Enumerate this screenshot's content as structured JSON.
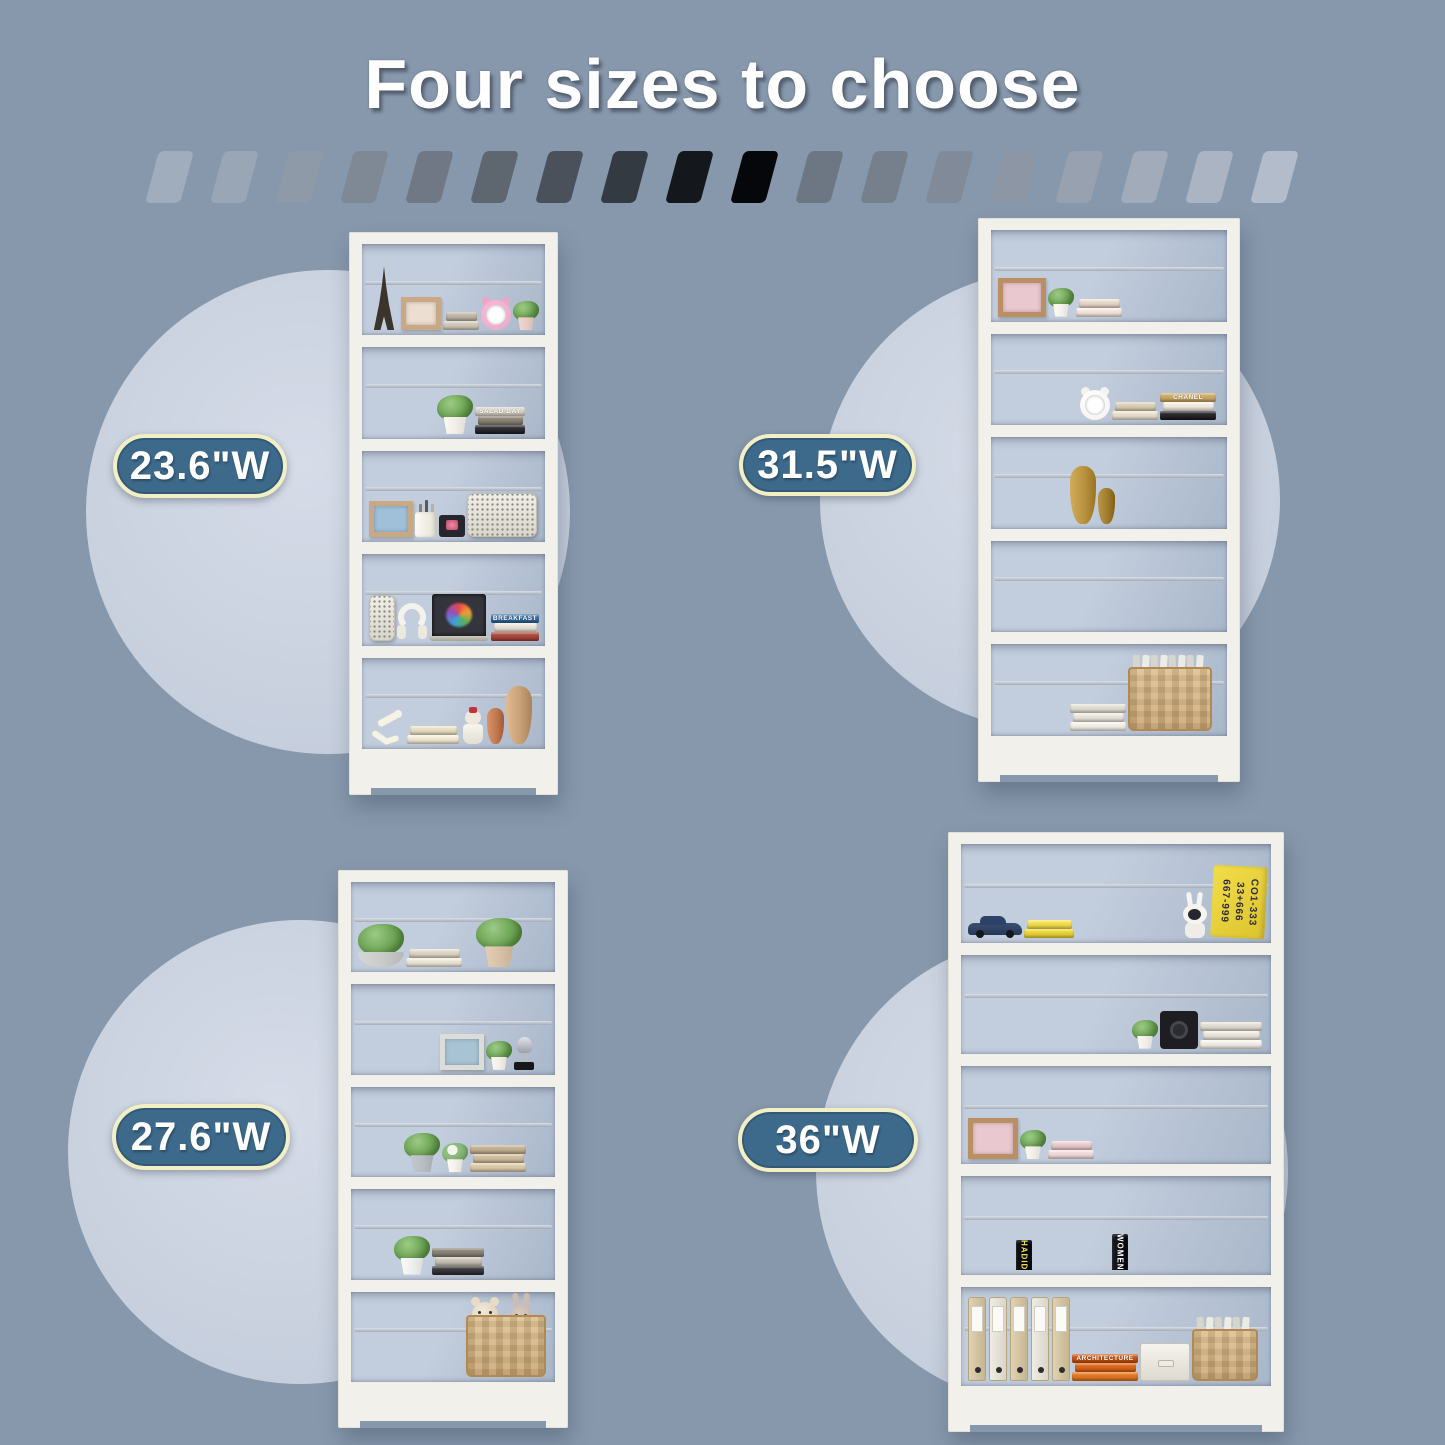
{
  "title": {
    "text": "Four sizes to choose"
  },
  "colors": {
    "background": "#8798ad",
    "circle_light": "#d6dce8",
    "circle_dark": "#c5cedc",
    "bookcase_frame": "#f2f0ea",
    "shelf_interior_light": "#c2cddd",
    "shelf_interior_dark": "#a9b7ca",
    "pill_fill": "#3d6a8b",
    "pill_border": "#f3efc5",
    "pill_text": "#ffffff",
    "title_text": "#ffffff"
  },
  "stripes": {
    "colors": [
      "#a0adbd",
      "#99a6b5",
      "#8f9aa9",
      "#7f8996",
      "#6f7884",
      "#5e666f",
      "#4a515a",
      "#343a42",
      "#14171c",
      "#06070a",
      "#6d7784",
      "#76808d",
      "#808a98",
      "#8c96a5",
      "#97a1b0",
      "#a1abba",
      "#aab4c3",
      "#b2bccb"
    ]
  },
  "sizes": [
    {
      "label": "23.6\"W",
      "position": "top-left"
    },
    {
      "label": "31.5\"W",
      "position": "top-right"
    },
    {
      "label": "27.6\"W",
      "position": "bottom-left"
    },
    {
      "label": "36\"W",
      "position": "bottom-right"
    }
  ],
  "bookcases": [
    {
      "size": "23.6\"W",
      "shelves": [
        [
          {
            "t": "tower"
          },
          {
            "t": "frame",
            "color": "#c9a985",
            "inner": "#ecdfd2",
            "size": 40
          },
          {
            "t": "stack",
            "colors": [
              "#cfc8ba",
              "#beb6a6"
            ],
            "w": 36
          },
          {
            "t": "clock",
            "color": "#e9a8c6"
          },
          {
            "t": "plant",
            "pot": "#e8cdc5",
            "size": "s"
          }
        ],
        [
          {
            "t": "books",
            "colors": [
              "#e6e1d7",
              "#3f3f45",
              "#23232a",
              "#b5a68c",
              "#6e6a60"
            ],
            "lean": [
              3
            ]
          },
          {
            "t": "plant",
            "pot": "#f2efe8",
            "size": "m"
          },
          {
            "t": "stack",
            "colors": [
              "#2e2e33",
              "#8c8375",
              "#d8d2c6"
            ],
            "w": 50,
            "label": "SALAD DAY"
          },
          {
            "t": "books",
            "colors": [
              "#efe9dd",
              "#3a3f52"
            ]
          }
        ],
        [
          {
            "t": "frame",
            "color": "#c9a985",
            "inner": "#9fc0d8",
            "size": 44
          },
          {
            "t": "cup"
          },
          {
            "t": "tv"
          },
          {
            "t": "speaker",
            "w": 70,
            "h": 44
          }
        ],
        [
          {
            "t": "speaker",
            "w": 26,
            "h": 46
          },
          {
            "t": "headphones"
          },
          {
            "t": "laptop",
            "w": 60
          },
          {
            "t": "stack",
            "colors": [
              "#a84a40",
              "#e8e2d6",
              "#3b6fa0"
            ],
            "w": 48,
            "label": "BREAKFAST"
          }
        ],
        [
          {
            "t": "figurine"
          },
          {
            "t": "stack",
            "colors": [
              "#efe7d2",
              "#e6dcc2"
            ],
            "w": 52
          },
          {
            "t": "doll"
          },
          {
            "t": "vase",
            "color": "#c07850",
            "size": "s"
          },
          {
            "t": "vase",
            "color": "#c8a078",
            "size": "l"
          }
        ]
      ]
    },
    {
      "size": "31.5\"W",
      "shelves": [
        [
          {
            "t": "frame",
            "color": "#b98f63",
            "inner": "#e9c9cf",
            "size": 48
          },
          {
            "t": "plant",
            "pot": "#f4f1ea",
            "size": "s"
          },
          {
            "t": "stack",
            "colors": [
              "#efe3da",
              "#e7d7cb"
            ],
            "w": 46
          },
          {
            "t": "books",
            "colors": [
              "#d9d4ca",
              "#3a3a3e",
              "#b7b0a4",
              "#8a8578",
              "#2b2b2e",
              "#cfcabf",
              "#974f47",
              "#50505a"
            ],
            "lean": [
              0
            ]
          }
        ],
        [
          {
            "t": "books",
            "colors": [
              "#ddceae",
              "#cbb895",
              "#b49e7c",
              "#e7dcc5",
              "#a98f6e",
              "#d2c2a4",
              "#8c7a5e"
            ]
          },
          {
            "t": "clock",
            "color": "#f4f2ee"
          },
          {
            "t": "stack",
            "colors": [
              "#e6ddcb",
              "#d9cdb4"
            ],
            "w": 46
          },
          {
            "t": "stack",
            "colors": [
              "#2a2a2e",
              "#efe9df",
              "#caa96a"
            ],
            "w": 56,
            "label": "CHANEL"
          }
        ],
        [
          {
            "t": "books",
            "colors": [
              "#3c3c42",
              "#55555c",
              "#2a2a30",
              "#6b6b74",
              "#47474e",
              "#26262c"
            ]
          },
          {
            "t": "vase",
            "color": "#b8923e",
            "size": "l"
          },
          {
            "t": "vase",
            "color": "#a07c2e",
            "size": "s"
          },
          {
            "t": "books",
            "colors": [
              "#b9a88c",
              "#d8cfc0",
              "#8d8375",
              "#c9c0b1",
              "#6f675a"
            ],
            "lean": [
              4
            ]
          },
          {
            "t": "books",
            "colors": [
              "#1e1e24",
              "#2c2c34",
              "#101016"
            ]
          }
        ],
        [
          {
            "t": "books",
            "wide": true,
            "colors": [
              "#e3ddd1",
              "#c95f52",
              "#ddd6c8",
              "#8e8878",
              "#b3aca0",
              "#5b5850",
              "#e8e2d6",
              "#a23f36",
              "#cfc8bb",
              "#77736a",
              "#e6e0d4",
              "#4e4a42",
              "#d4cec2",
              "#9a948a",
              "#ece6da"
            ],
            "lean": [
              6
            ]
          }
        ],
        [
          {
            "t": "books",
            "colors": [
              "#6b4a38",
              "#8a6a50",
              "#4a3327",
              "#9c7d62",
              "#5d4433",
              "#7d5c44"
            ]
          },
          {
            "t": "stack",
            "colors": [
              "#efece4",
              "#e7e4da",
              "#dfdcd2"
            ],
            "w": 56
          },
          {
            "t": "basket",
            "w": 84,
            "h": 76,
            "contents": "books"
          }
        ]
      ]
    },
    {
      "size": "27.6\"W",
      "shelves": [
        [
          {
            "t": "plant",
            "pot": "#c9ccc9",
            "size": "l",
            "shape": "bowl"
          },
          {
            "t": "stack",
            "colors": [
              "#eae4d8",
              "#ddd5c5"
            ],
            "w": 56
          },
          {
            "t": "gap",
            "w": 10
          },
          {
            "t": "plant",
            "pot": "#d9c2a8",
            "size": "l"
          }
        ],
        [
          {
            "t": "books",
            "colors": [
              "#e7e2d8",
              "#4e4e56",
              "#2e2e34",
              "#9c4f44",
              "#cdc6ba",
              "#6f6a61",
              "#ded8cc"
            ]
          },
          {
            "t": "frame",
            "color": "#dcdcd8",
            "inner": "#a8c4d4",
            "size": 44
          },
          {
            "t": "plant",
            "pot": "#f2efe8",
            "size": "s"
          },
          {
            "t": "trophy"
          }
        ],
        [
          {
            "t": "books",
            "colors": [
              "#c9b394",
              "#b49a78",
              "#8a7257",
              "#dac7a8"
            ]
          },
          {
            "t": "plant",
            "pot": "#b9bec5",
            "size": "m"
          },
          {
            "t": "plant",
            "pot": "#f4f1ea",
            "size": "s",
            "flower": true
          },
          {
            "t": "stack",
            "colors": [
              "#d9c8a9",
              "#cdbc9d",
              "#c1b091"
            ],
            "w": 56
          },
          {
            "t": "books",
            "colors": [
              "#c2a684",
              "#a88c6a"
            ],
            "lean": [
              1
            ]
          }
        ],
        [
          {
            "t": "books",
            "colors": [
              "#2f3a3e",
              "#455055",
              "#1f282c"
            ]
          },
          {
            "t": "plant",
            "pot": "#eef0ee",
            "size": "m"
          },
          {
            "t": "stack",
            "colors": [
              "#3a3a40",
              "#c8c2b6",
              "#8a8478"
            ],
            "w": 52
          },
          {
            "t": "books",
            "colors": [
              "#5a5550",
              "#c4beb2",
              "#d8524a",
              "#e8e2d6",
              "#e98f7f",
              "#cfc9bd"
            ],
            "lean": [
              0
            ]
          }
        ],
        [
          {
            "t": "books",
            "hmin": 62,
            "hmax": 92,
            "colors": [
              "#e89b3c",
              "#3aa8a0",
              "#2f6fb0",
              "#8e5fb0",
              "#52b06a",
              "#e8c23c",
              "#d86a9c",
              "#48b8c8",
              "#b0742f"
            ]
          },
          {
            "t": "basket",
            "w": 80,
            "h": 74,
            "contents": "teddy"
          }
        ]
      ]
    },
    {
      "size": "36\"W",
      "shelves": [
        [
          {
            "t": "car"
          },
          {
            "t": "stack",
            "colors": [
              "#e8d23c",
              "#f0dc50"
            ],
            "w": 50
          },
          {
            "t": "books",
            "hmin": 60,
            "hmax": 92,
            "colors": [
              "#e04848",
              "#f0a0c0",
              "#48b060",
              "#f0d040",
              "#4888d0",
              "#e87030",
              "#d04890",
              "#70c8e0"
            ],
            "lean": [
              7
            ]
          },
          {
            "t": "bunny"
          },
          {
            "t": "numbers",
            "lines": [
              "667-999",
              "33+666",
              "CO1-333"
            ]
          }
        ],
        [
          {
            "t": "books",
            "colors": [
              "#e8e0d0",
              "#d0c0a0",
              "#b8a080",
              "#f0e8d8",
              "#a08868",
              "#d8ccb4",
              "#c8b494",
              "#907858",
              "#e0d4bc",
              "#c4b294",
              "#efe8da",
              "#b0a284",
              "#e4dcc8"
            ],
            "lean": [
              9
            ]
          },
          {
            "t": "plant",
            "pot": "#f2efe8",
            "size": "s"
          },
          {
            "t": "speakerbox"
          },
          {
            "t": "stack",
            "colors": [
              "#f0ece4",
              "#e8e4da",
              "#e0dcd2"
            ],
            "w": 62
          }
        ],
        [
          {
            "t": "frame",
            "color": "#b98f63",
            "inner": "#e9c9cf",
            "size": 50
          },
          {
            "t": "plant",
            "pot": "#f2efe8",
            "size": "s"
          },
          {
            "t": "stack",
            "colors": [
              "#efd9d9",
              "#e8cccc"
            ],
            "w": 46
          },
          {
            "t": "books",
            "colors": [
              "#e8e2d6",
              "#cfc6b6",
              "#b0a590",
              "#968b76",
              "#d8d0c2",
              "#c05048",
              "#4a4a50",
              "#e2dacb",
              "#7d7668",
              "#c9c0b0",
              "#8f8678",
              "#ded6c6",
              "#6a645a"
            ],
            "lean": [
              2
            ]
          }
        ],
        [
          {
            "t": "books",
            "wide": true,
            "colors": [
              "#e8e4da",
              "#f0ece2",
              "#d8d4ca"
            ]
          },
          {
            "t": "books",
            "colors": [
              "#101014"
            ],
            "labels": [
              "HADID"
            ],
            "labelColor": "#e8e050"
          },
          {
            "t": "books",
            "wide": true,
            "colors": [
              "#e87868",
              "#f0a088",
              "#d84838",
              "#e8e2d6",
              "#c8c2b6"
            ]
          },
          {
            "t": "books",
            "colors": [
              "#1a1a20"
            ],
            "labels": [
              "WOMEN"
            ],
            "labelColor": "#ffffff"
          },
          {
            "t": "books",
            "wide": true,
            "colors": [
              "#e89060",
              "#c87840",
              "#a86830",
              "#d0b890",
              "#e8a070",
              "#b87838",
              "#d88850",
              "#e0b088"
            ]
          }
        ],
        [
          {
            "t": "binders",
            "n": 5
          },
          {
            "t": "stack",
            "colors": [
              "#e07828",
              "#d86820",
              "#c85818"
            ],
            "w": 66,
            "label": "ARCHITECTURE"
          },
          {
            "t": "box"
          },
          {
            "t": "basket",
            "w": 66,
            "h": 64,
            "contents": "books"
          }
        ]
      ]
    }
  ]
}
